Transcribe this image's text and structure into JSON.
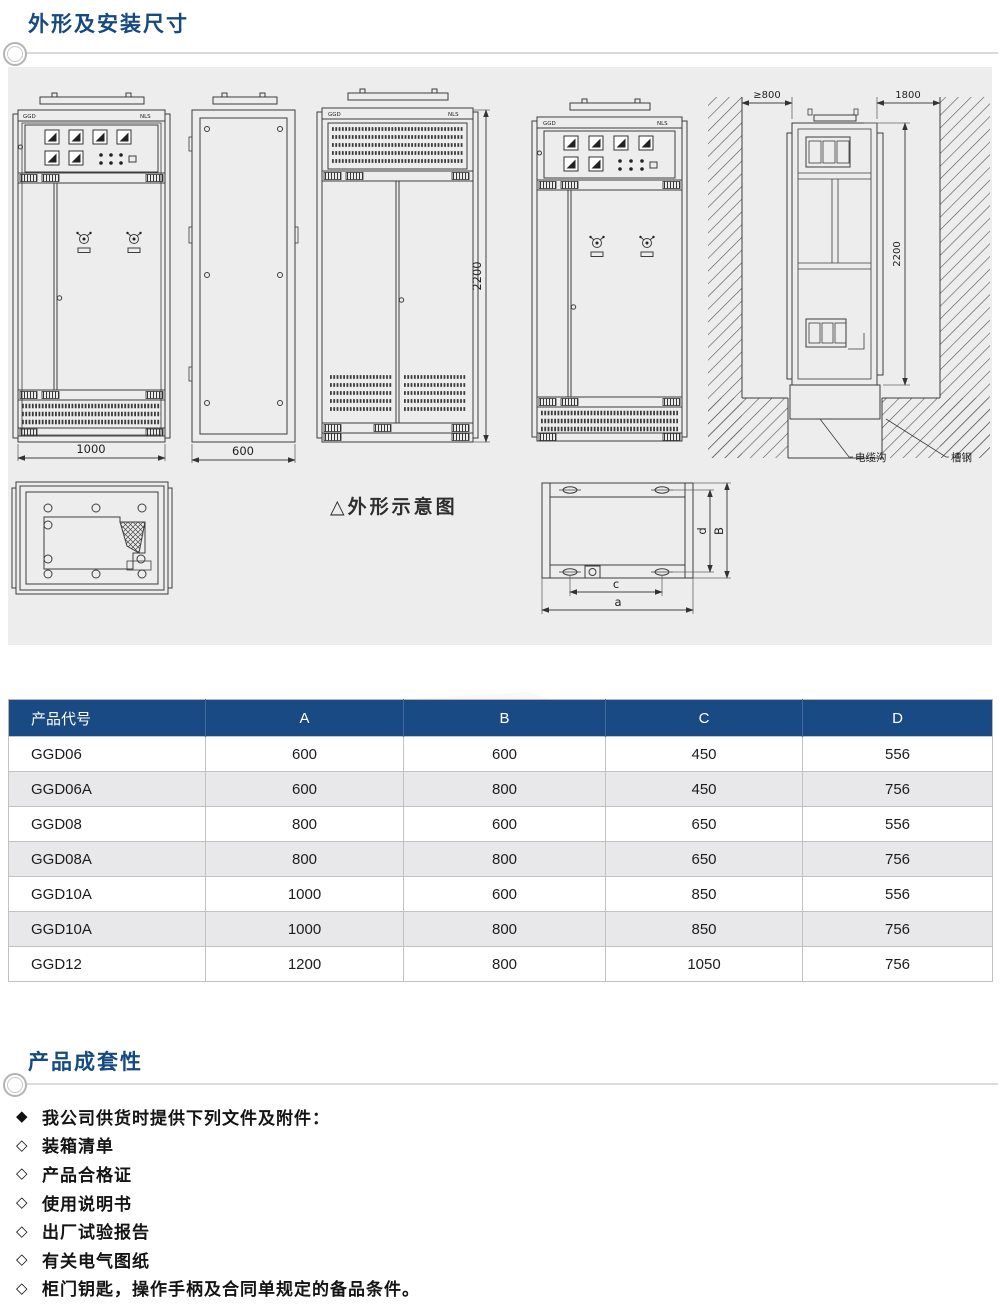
{
  "colors": {
    "accent_navy": "#194a83",
    "title_navy": "#16497f",
    "panel_bg": "#ededed"
  },
  "header": {
    "section1_title": "外形及安装尺寸",
    "section2_title": "产品成套性"
  },
  "drawings": {
    "caption": "△外形示意图",
    "front_view": {
      "label_left": "GGD",
      "label_right": "NLS",
      "width_dim": "1000"
    },
    "side_view": {
      "width_dim": "600"
    },
    "rear_view": {
      "label_left": "GGD",
      "label_right": "NLS",
      "height_dim": "2200"
    },
    "front_view2": {
      "label_left": "GGD",
      "label_right": "NLS"
    },
    "installation": {
      "left_clearance_dim": "≥800",
      "right_clearance_dim": "1800",
      "height_dim": "2200",
      "cable_trench_label": "电缆沟",
      "channel_steel_label": "槽钢"
    },
    "base_plan": {
      "dim_a": "a",
      "dim_b": "B",
      "dim_c": "c",
      "dim_d": "d"
    }
  },
  "table": {
    "headers": [
      "产品代号",
      "A",
      "B",
      "C",
      "D"
    ],
    "rows": [
      [
        "GGD06",
        "600",
        "600",
        "450",
        "556"
      ],
      [
        "GGD06A",
        "600",
        "800",
        "450",
        "756"
      ],
      [
        "GGD08",
        "800",
        "600",
        "650",
        "556"
      ],
      [
        "GGD08A",
        "800",
        "800",
        "650",
        "756"
      ],
      [
        "GGD10A",
        "1000",
        "600",
        "850",
        "556"
      ],
      [
        "GGD10A",
        "1000",
        "800",
        "850",
        "756"
      ],
      [
        "GGD12",
        "1200",
        "800",
        "1050",
        "756"
      ]
    ]
  },
  "completeness": {
    "intro_bullet": "◆",
    "item_bullet": "◇",
    "intro": "我公司供货时提供下列文件及附件：",
    "items": [
      "装箱清单",
      "产品合格证",
      "使用说明书",
      "出厂试验报告",
      "有关电气图纸",
      "柜门钥匙，操作手柄及合同单规定的备品条件。"
    ]
  }
}
